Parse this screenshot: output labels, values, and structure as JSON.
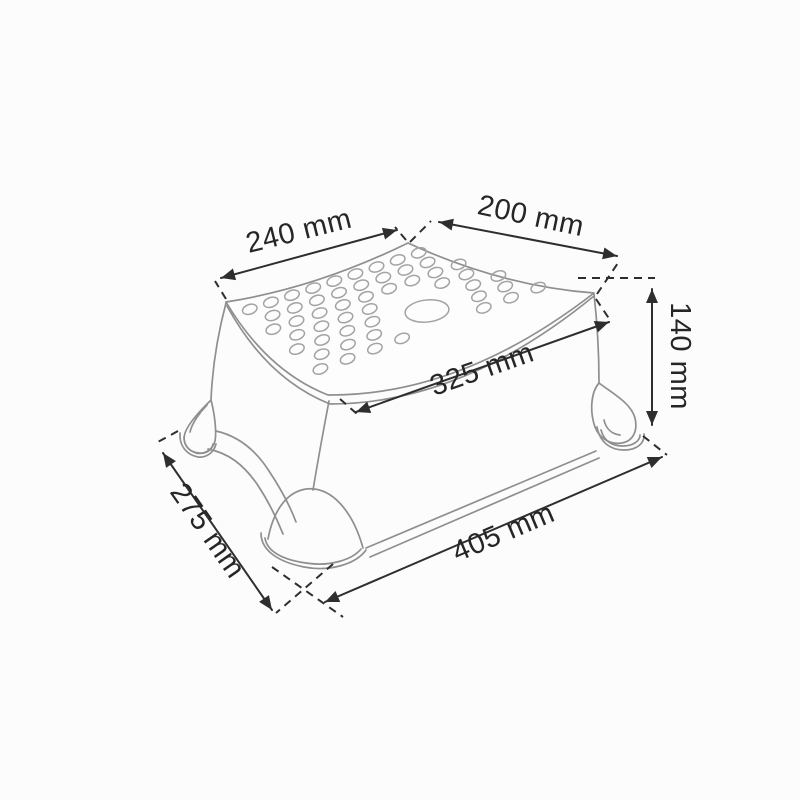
{
  "diagram": {
    "kind": "technical-dimension-drawing",
    "subject": "baby-step-stool",
    "unit": "mm",
    "dimensions": {
      "seat_left_edge": "240 mm",
      "seat_right_edge": "200 mm",
      "height": "140 mm",
      "seat_diagonal": "325 mm",
      "base_front_edge": "405 mm",
      "base_left_edge": "275 mm"
    },
    "colors": {
      "background": "#fcfcfc",
      "product_outline": "#8f8f8f",
      "dot_pattern": "#a3a3a3",
      "dimension_lines": "#2e2e2e",
      "label_text": "#262626"
    }
  }
}
